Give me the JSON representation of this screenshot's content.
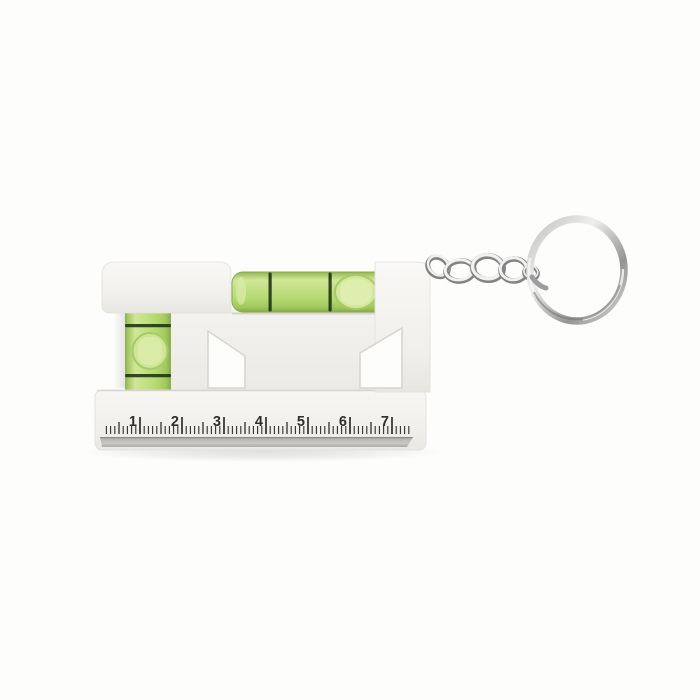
{
  "image": {
    "type": "product-photo",
    "subject": "Pocket spirit level keyring with ruler edge",
    "background_color": "#fdfdfc"
  },
  "level": {
    "body_color": "#f2f1ed",
    "vials": {
      "fluid_color": "#bedc7b",
      "bubble_color": "#d8eaa8",
      "marker_line_color": "#1d3013",
      "horizontal_vial": {
        "marker_lines": 2,
        "bubble_position": "right-of-center"
      },
      "vertical_vial": {
        "marker_lines": 2,
        "bubble_position": "centered"
      }
    },
    "ruler": {
      "numbers": [
        "1",
        "2",
        "3",
        "4",
        "5",
        "6",
        "7"
      ],
      "minor_ticks_per_unit": 10,
      "tick_color": "#2e2e2c",
      "edge_strip_color": "#b5b4b1"
    }
  },
  "keyring": {
    "metal_color": "#c6c6c6",
    "chain_link_count": 5,
    "ring_shape": "split-ring"
  }
}
